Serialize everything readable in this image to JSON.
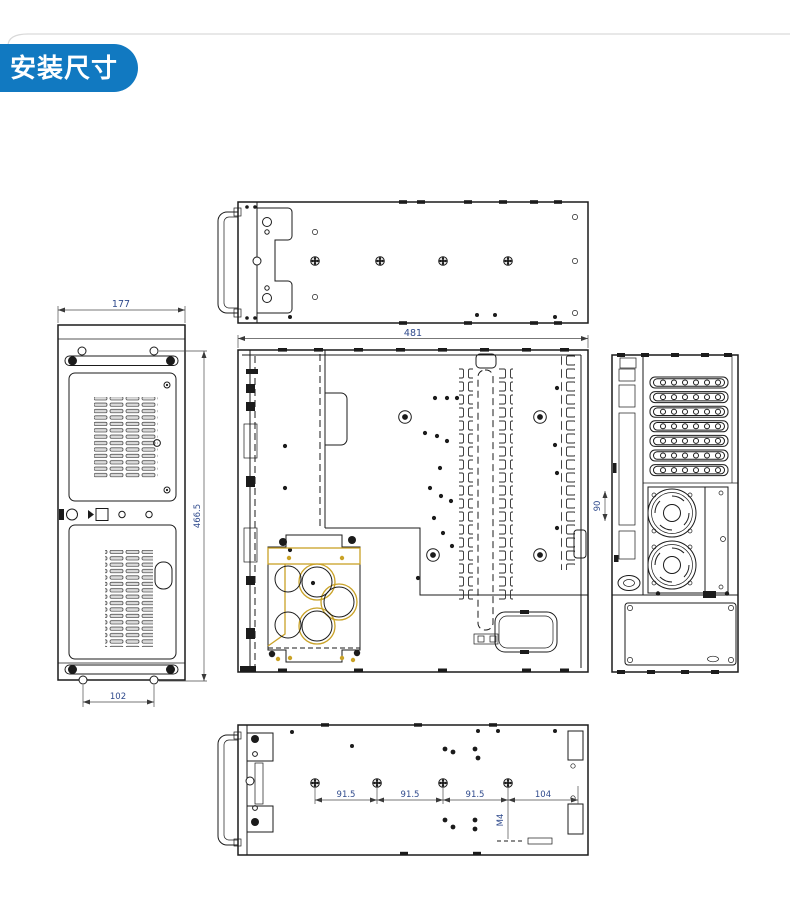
{
  "page": {
    "badge": "安装尺寸"
  },
  "colors": {
    "badge_bg": "#1179c1",
    "badge_text": "#ffffff",
    "line": "#1b1b1b",
    "dim_text": "#2f4a8c",
    "highlight": "#c9a227"
  },
  "dimensions": {
    "top_width": "481",
    "front_width": "177",
    "front_hole_spacing": "102",
    "depth": "466.5",
    "rear_segment": "90",
    "bottom_spacings": [
      "91.5",
      "91.5",
      "91.5",
      "104"
    ],
    "bottom_hole_callout": "M4"
  }
}
